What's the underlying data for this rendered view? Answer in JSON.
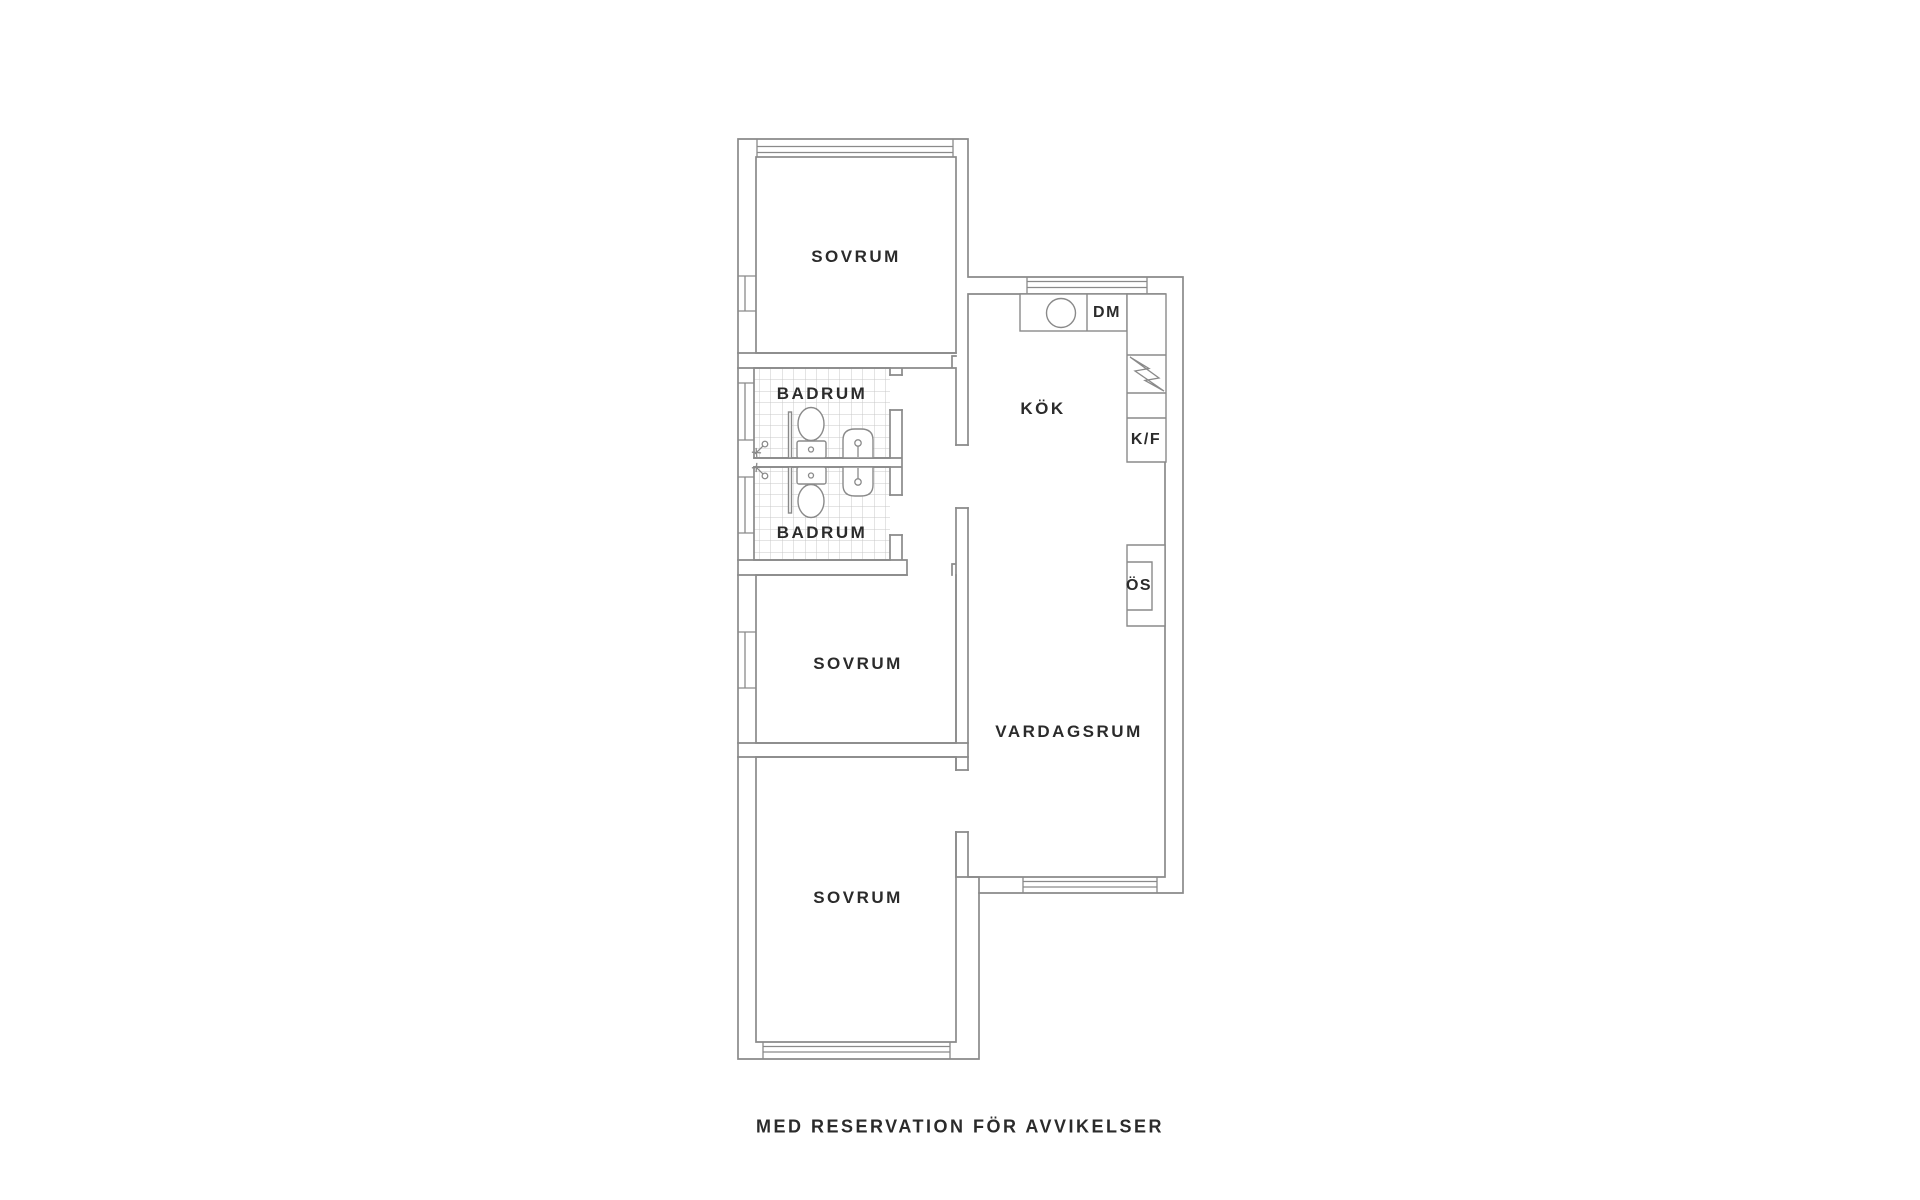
{
  "floorplan": {
    "rooms": {
      "bedroom_top": "SOVRUM",
      "bathroom_top": "BADRUM",
      "bathroom_bottom": "BADRUM",
      "kitchen": "KÖK",
      "bedroom_middle": "SOVRUM",
      "living_room": "VARDAGSRUM",
      "bedroom_bottom": "SOVRUM"
    },
    "appliances": {
      "dishwasher": "DM",
      "fridge_freezer": "K/F",
      "fireplace": "ÖS"
    },
    "caption": "MED RESERVATION FÖR AVVIKELSER",
    "colors": {
      "wall_line": "#8a8a8a",
      "tile_line": "#c9c9c9",
      "text": "#2b2b2b",
      "background": "#ffffff"
    }
  }
}
